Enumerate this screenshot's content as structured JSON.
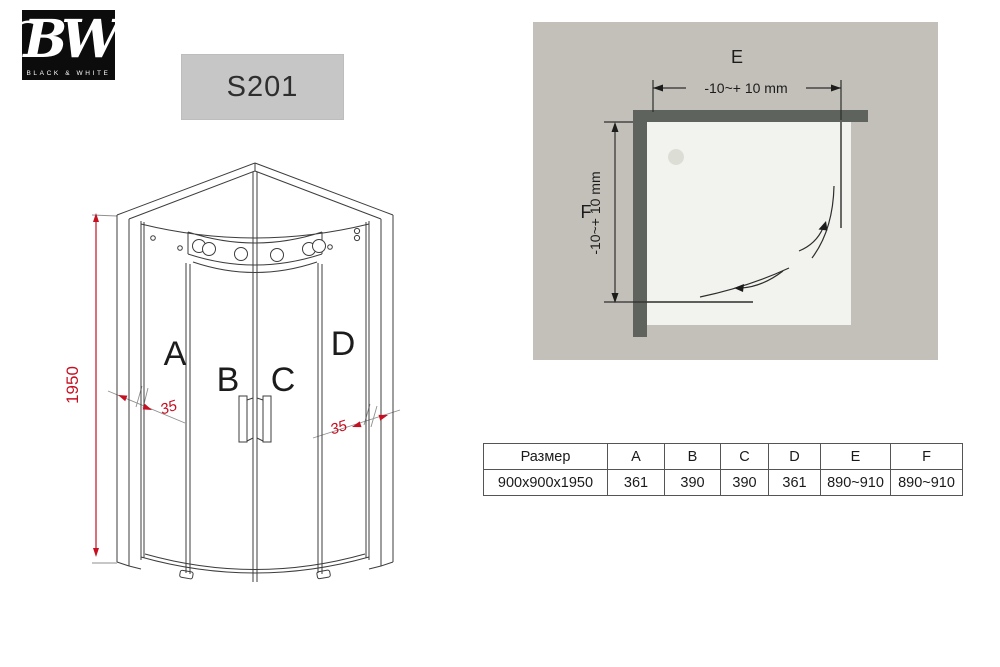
{
  "colors": {
    "accent-red": "#c51022",
    "line": "#3d3d3d",
    "plan-bg": "#c3c0ba",
    "plan-wall": "#5f635d",
    "plan-tray": "#f2f3ee",
    "plan-drain": "#dcded6",
    "model-box-bg": "#c6c6c6"
  },
  "logo": {
    "text": "BW",
    "caption": "BLACK & WHITE"
  },
  "model": {
    "code": "S201"
  },
  "elevation": {
    "height": "1950",
    "overlap_left": "35",
    "overlap_right": "35",
    "panels": {
      "a": "A",
      "b": "B",
      "c": "C",
      "d": "D"
    }
  },
  "plan": {
    "width_letter": "E",
    "depth_letter": "F",
    "width_tolerance": "-10~+ 10 mm",
    "depth_tolerance": "-10~+ 10 mm"
  },
  "table": {
    "headers": [
      "Размер",
      "A",
      "B",
      "C",
      "D",
      "E",
      "F"
    ],
    "rows": [
      [
        "900x900x1950",
        "361",
        "390",
        "390",
        "361",
        "890~910",
        "890~910"
      ]
    ]
  }
}
